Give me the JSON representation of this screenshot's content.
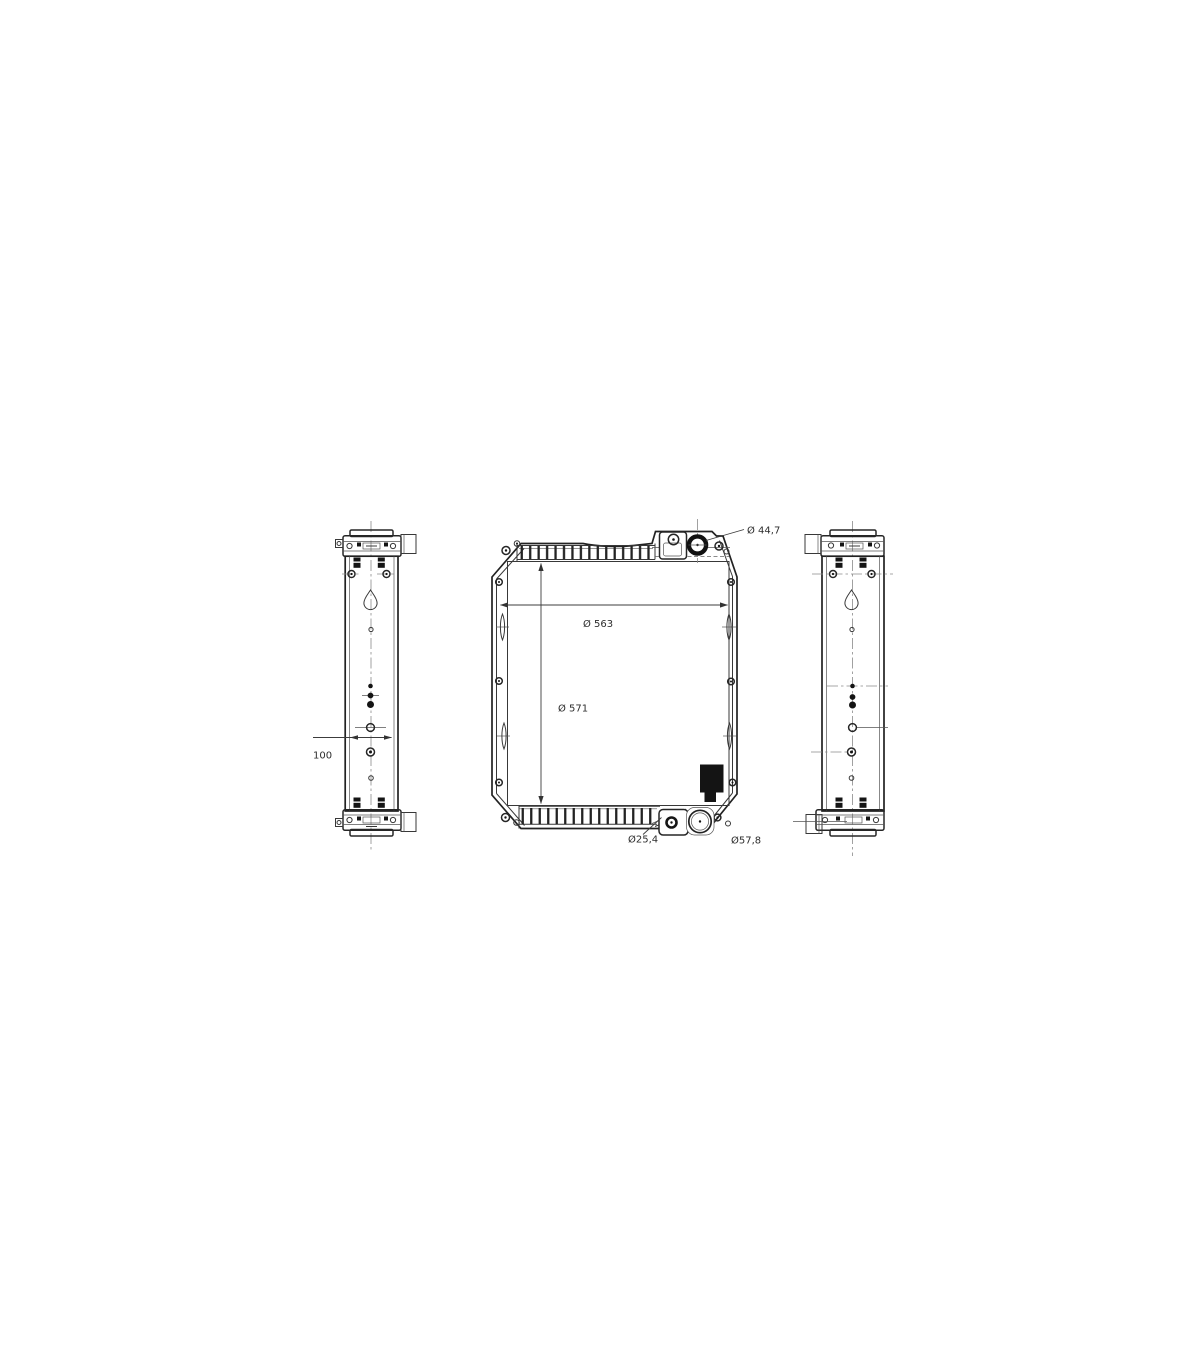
{
  "page": {
    "background": "#ffffff"
  },
  "drawing": {
    "description": "three-view technical line drawing of a radiator",
    "line_color": "#2e2e2e",
    "views": [
      "left-side-view",
      "front-view",
      "right-side-view"
    ]
  },
  "labels": {
    "dim_44_7": "Ø 44,7",
    "dim_563": "Ø 563",
    "dim_571": "Ø 571",
    "dim_25_4": "Ø25,4",
    "dim_57_8": "Ø57,8",
    "dim_100": "100"
  }
}
